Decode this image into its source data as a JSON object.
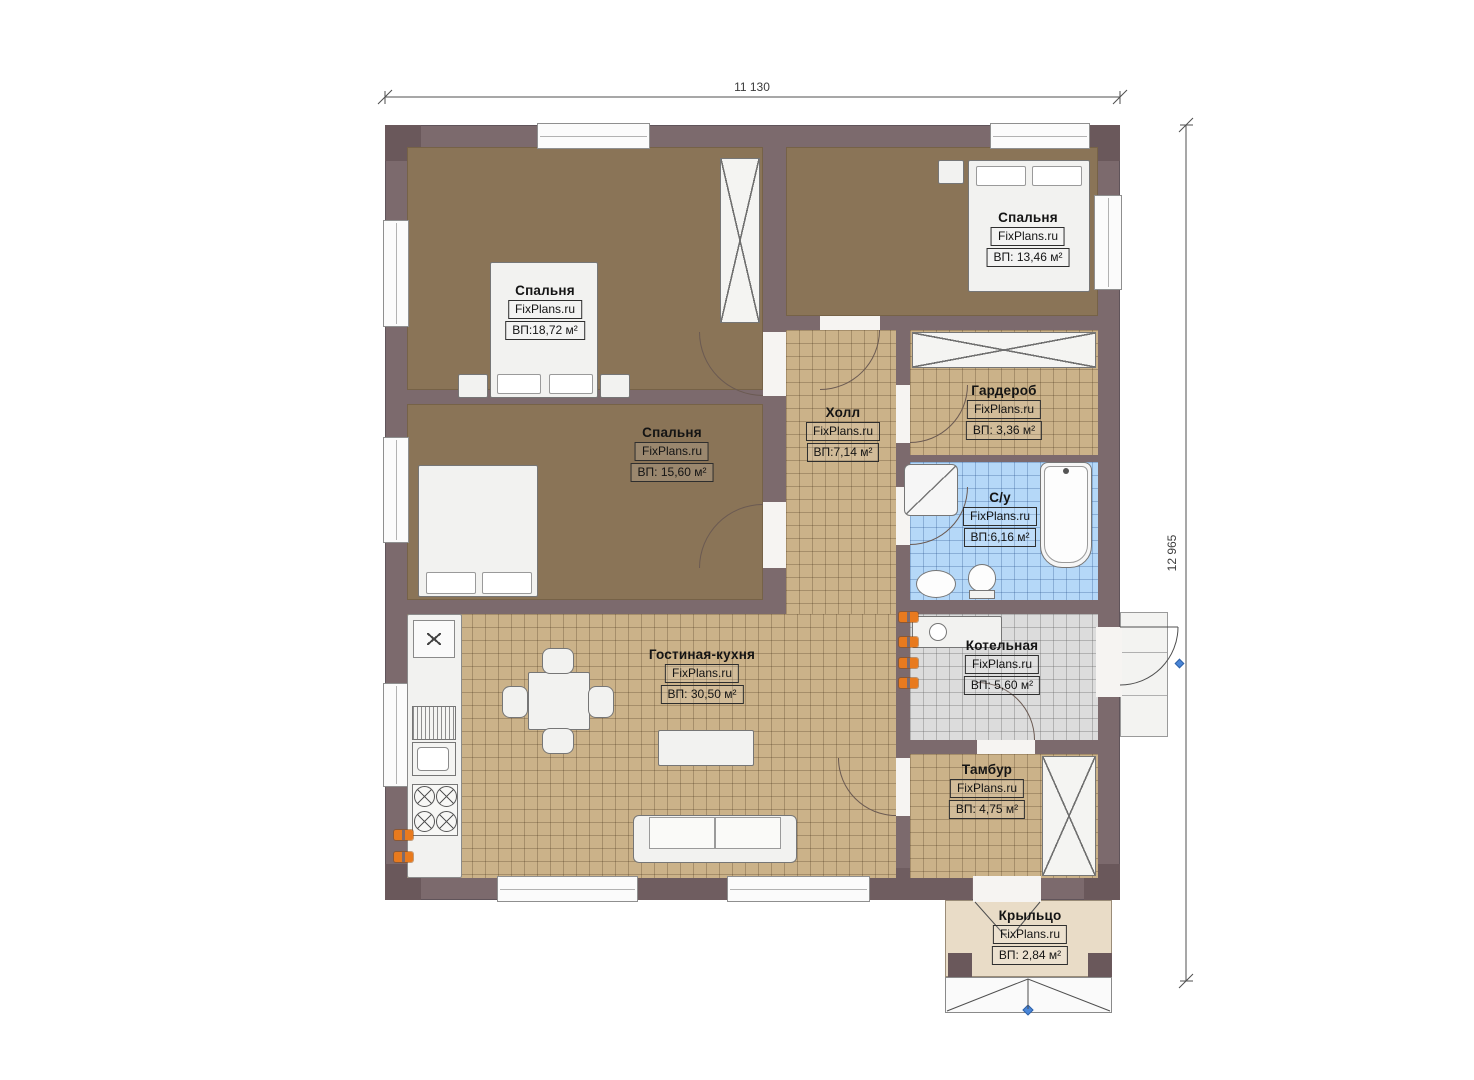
{
  "meta": {
    "brand": "FixPlans.ru",
    "drawing_type": "floor plan"
  },
  "dimensions": {
    "width_mm": "11 130",
    "height_mm": "12 965"
  },
  "rooms": [
    {
      "name": "Спальня",
      "area": "ВП:18,72 м²"
    },
    {
      "name": "Спальня",
      "area": "ВП: 13,46 м²"
    },
    {
      "name": "Спальня",
      "area": "ВП: 15,60 м²"
    },
    {
      "name": "Холл",
      "area": "ВП:7,14 м²"
    },
    {
      "name": "Гардероб",
      "area": "ВП: 3,36 м²"
    },
    {
      "name": "С/у",
      "area": "ВП:6,16 м²"
    },
    {
      "name": "Котельная",
      "area": "ВП: 5,60 м²"
    },
    {
      "name": "Гостиная-кухня",
      "area": "ВП: 30,50 м²"
    },
    {
      "name": "Тамбур",
      "area": "ВП: 4,75 м²"
    },
    {
      "name": "Крыльцо",
      "area": "ВП: 2,84 м²"
    }
  ],
  "colors": {
    "wall": "#7c6a6d",
    "carpet_floor": "#8a7457",
    "tile_tan": "#cbb289",
    "tile_blue": "#b5d8f8",
    "tile_gray": "#dcdcdc",
    "porch_floor": "#e9dcc7",
    "socket_orange": "#e87a1e",
    "marker_blue": "#4a86d8"
  }
}
